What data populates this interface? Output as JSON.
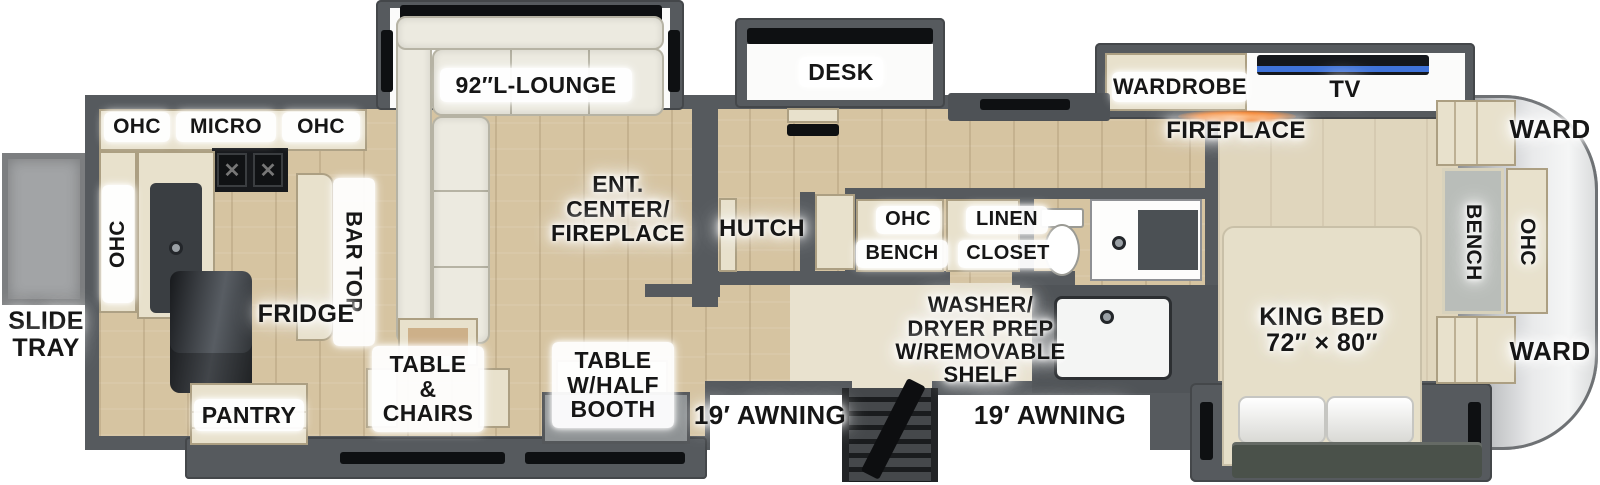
{
  "labels": {
    "slide_tray": "SLIDE\nTRAY",
    "awning_left": "19′ AWNING",
    "awning_right": "19′ AWNING",
    "ohc_top_left": "OHC",
    "micro": "MICRO",
    "ohc_top_right": "OHC",
    "ohc_side_wall": "OHC",
    "bar_top": "BAR TOP",
    "fridge": "FRIDGE",
    "pantry": "PANTRY",
    "lounge": "92″L-LOUNGE",
    "ent_center": "ENT.\nCENTER/\nFIREPLACE",
    "hutch": "HUTCH",
    "desk": "DESK",
    "table_chairs": "TABLE\n&\nCHAIRS",
    "table_half_booth": "TABLE\nW/HALF\nBOOTH",
    "bath_ohc": "OHC",
    "bath_bench": "BENCH",
    "linen": "LINEN",
    "closet": "CLOSET",
    "washer_dryer": "WASHER/\nDRYER PREP\nW/REMOVABLE\nSHELF",
    "wardrobe": "WARDROBE",
    "tv": "TV",
    "fireplace": "FIREPLACE",
    "king_bed": "KING BED\n72″ × 80″",
    "ward_top": "WARD",
    "ward_bottom": "WARD",
    "rear_ohc": "OHC",
    "rear_bench": "BENCH"
  },
  "colors": {
    "wall": "#565A5E",
    "floor_wood": "#D6C4A1",
    "floor_bedroom": "#E0D6BD",
    "floor_hall": "#E9E2CF",
    "cabinet_cream": "#E8E1CC",
    "sofa_cream": "#ECEAE0",
    "appliance_black": "#17191C",
    "slide_tray_gray": "#A2A4A6",
    "rear_cap_silver": "#E9EAEB",
    "tv_blue": "#3F73D9",
    "fireplace_orange": "#F47B20",
    "bed_cream": "#E6DFC9",
    "footboard_green": "#4A514A",
    "label_text": "#161616"
  }
}
